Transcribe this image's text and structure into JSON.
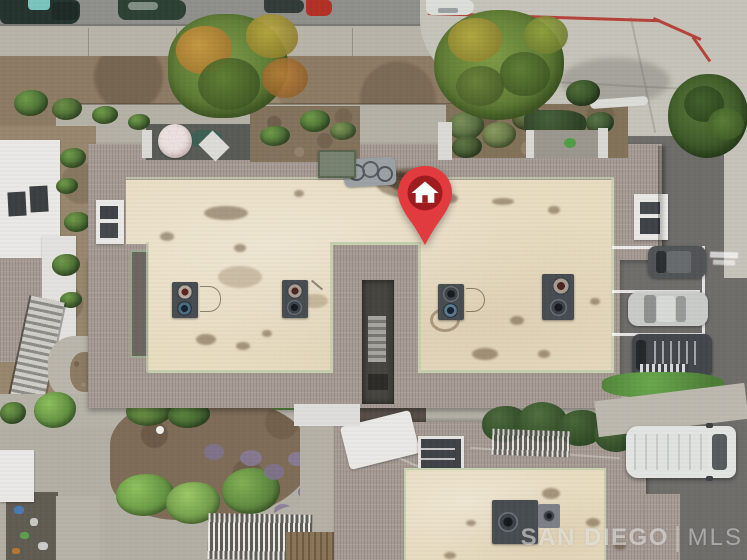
{
  "scene": {
    "type": "aerial real estate photo",
    "description": "Top-down drone view of a condominium building with cream flat roofs, gray shingle roof borders, rooftop HVAC units, balconies with a patio umbrella, landscaped walkways, street parking above and a parking lot to the right.",
    "marker": {
      "icon": "home-icon",
      "pin_color": "#e23b3f",
      "inner_circle_color": "#9e1c1f",
      "glyph_color": "#ffffff"
    },
    "watermark": {
      "brand": "SAN DIEGO",
      "separator": "|",
      "suffix": "MLS",
      "color": "#ffffff",
      "opacity": 0.55
    }
  }
}
